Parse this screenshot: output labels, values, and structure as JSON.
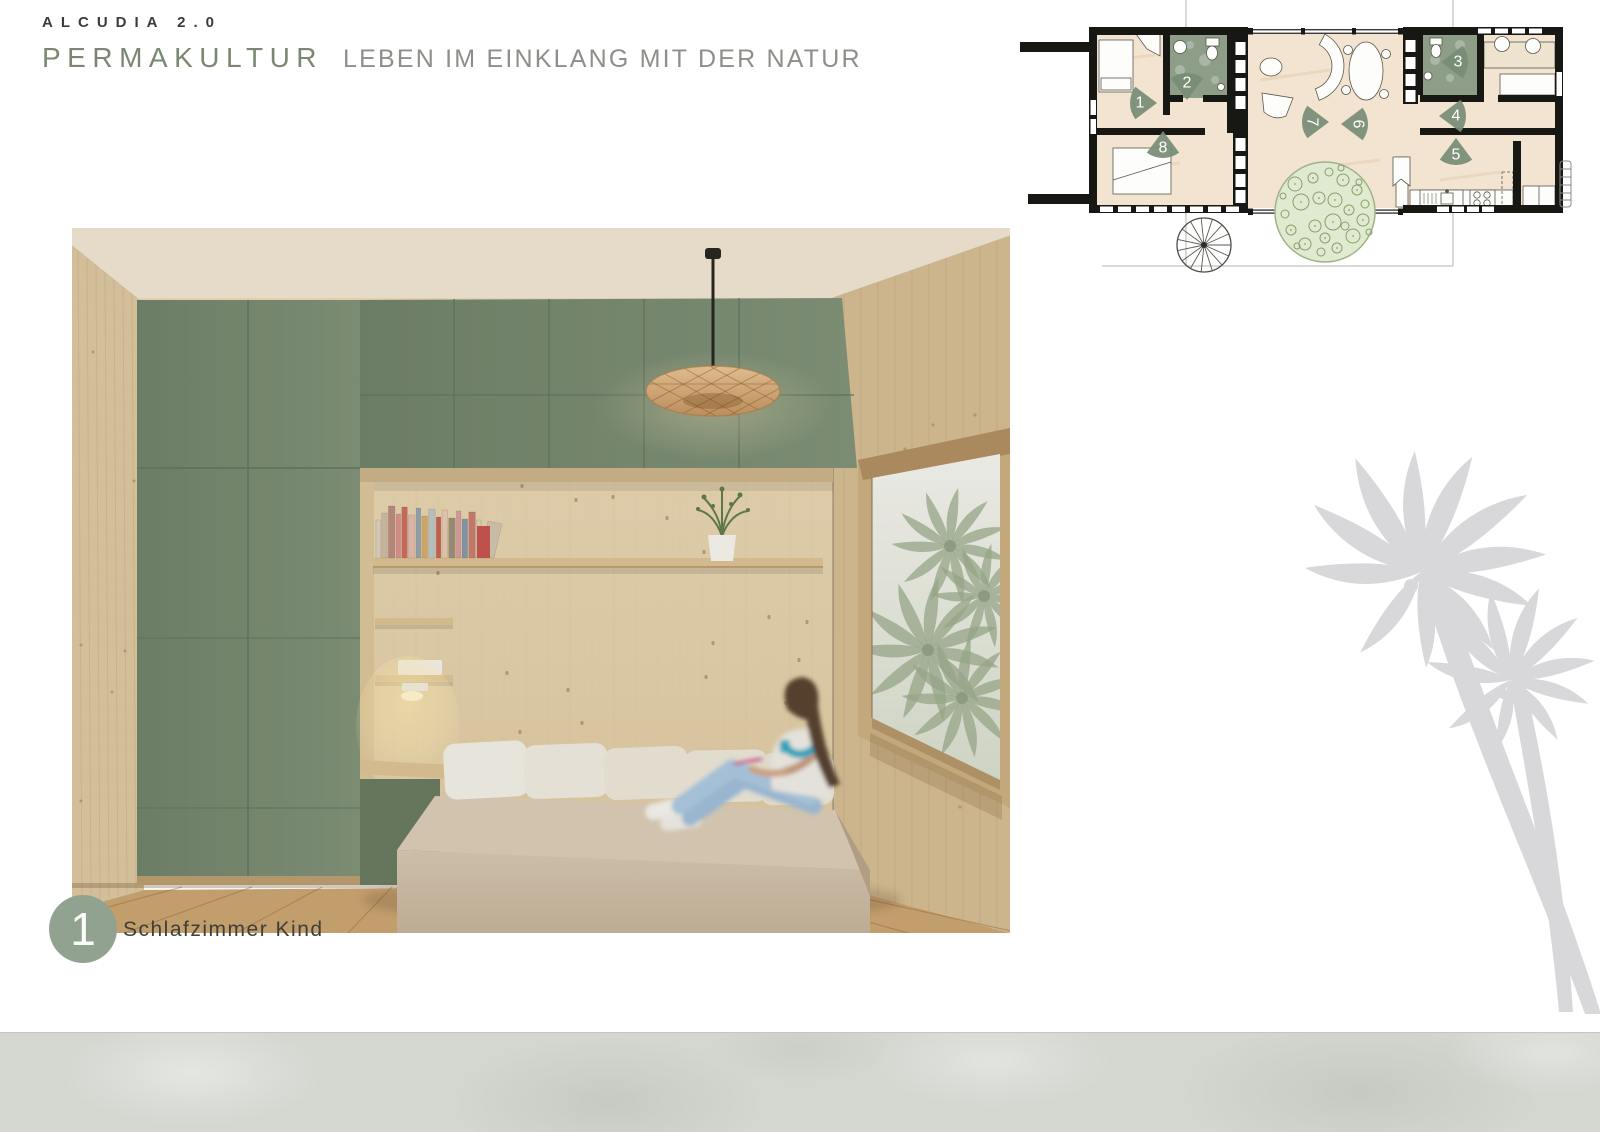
{
  "header": {
    "project": "ALCUDIA 2.0",
    "title": "PERMAKULTUR",
    "subtitle": "LEBEN IM EINKLANG MIT DER NATUR"
  },
  "caption": {
    "number": "1",
    "label": "Schlafzimmer Kind"
  },
  "floorplan": {
    "markers": [
      {
        "n": "1",
        "x": 1157,
        "y": 103,
        "dir": 0,
        "trot": 0
      },
      {
        "n": "2",
        "x": 1187,
        "y": 100,
        "dir": 90,
        "trot": 0
      },
      {
        "n": "3",
        "x": 1441,
        "y": 62,
        "dir": 180,
        "trot": 0
      },
      {
        "n": "4",
        "x": 1439,
        "y": 116,
        "dir": 180,
        "trot": 0
      },
      {
        "n": "5",
        "x": 1456,
        "y": 138,
        "dir": 270,
        "trot": 0
      },
      {
        "n": "6",
        "x": 1341,
        "y": 124,
        "dir": 180,
        "trot": 90
      },
      {
        "n": "7",
        "x": 1329,
        "y": 122,
        "dir": 0,
        "trot": 90
      },
      {
        "n": "8",
        "x": 1163,
        "y": 131,
        "dir": 270,
        "trot": 0
      }
    ]
  },
  "colors": {
    "accent_green": "#7b8772",
    "marker_green": "#788c75",
    "badge_green": "#92a291",
    "cabinet_green": "#76886f",
    "wall_black": "#171713",
    "floor_beige": "#f2e4d1",
    "bath_green": "#8d9d88",
    "concrete": "#d4d7d0",
    "watermark_gray": "#d8d8da"
  }
}
